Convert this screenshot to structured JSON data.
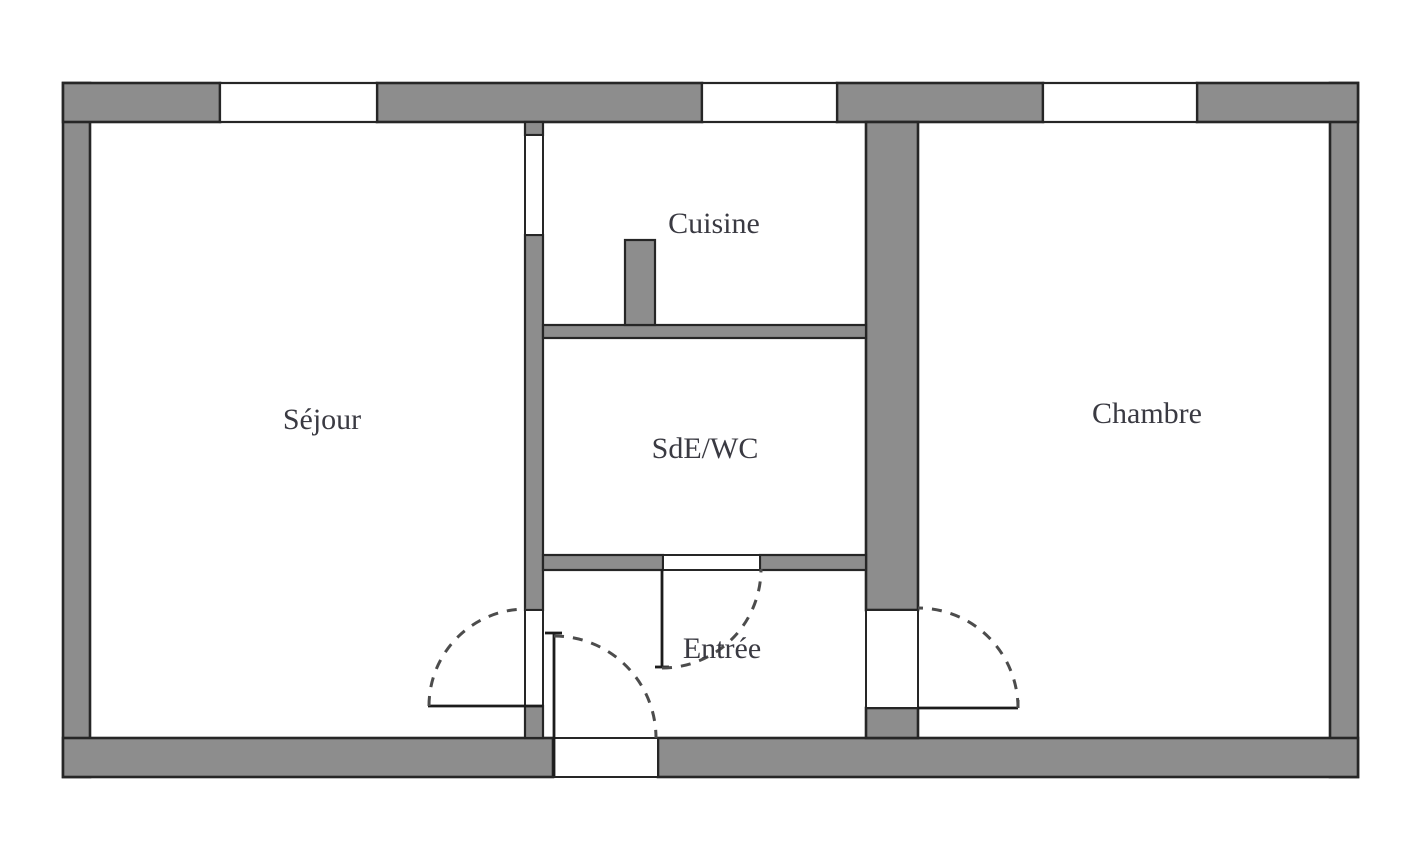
{
  "plan": {
    "title": "Floor plan",
    "rooms": [
      {
        "id": "sejour",
        "label": "Séjour"
      },
      {
        "id": "cuisine",
        "label": "Cuisine"
      },
      {
        "id": "sde_wc",
        "label": "SdE/WC"
      },
      {
        "id": "entree",
        "label": "Entrée"
      },
      {
        "id": "chambre",
        "label": "Chambre"
      }
    ],
    "colors": {
      "background": "#ffffff",
      "wall_fill": "#8d8d8d",
      "wall_outline": "#262626",
      "room_fill": "#ffffff",
      "label_color": "#3a3a42",
      "door_arc": "#4c4c4c",
      "door_leaf": "#1c1c1c"
    }
  }
}
